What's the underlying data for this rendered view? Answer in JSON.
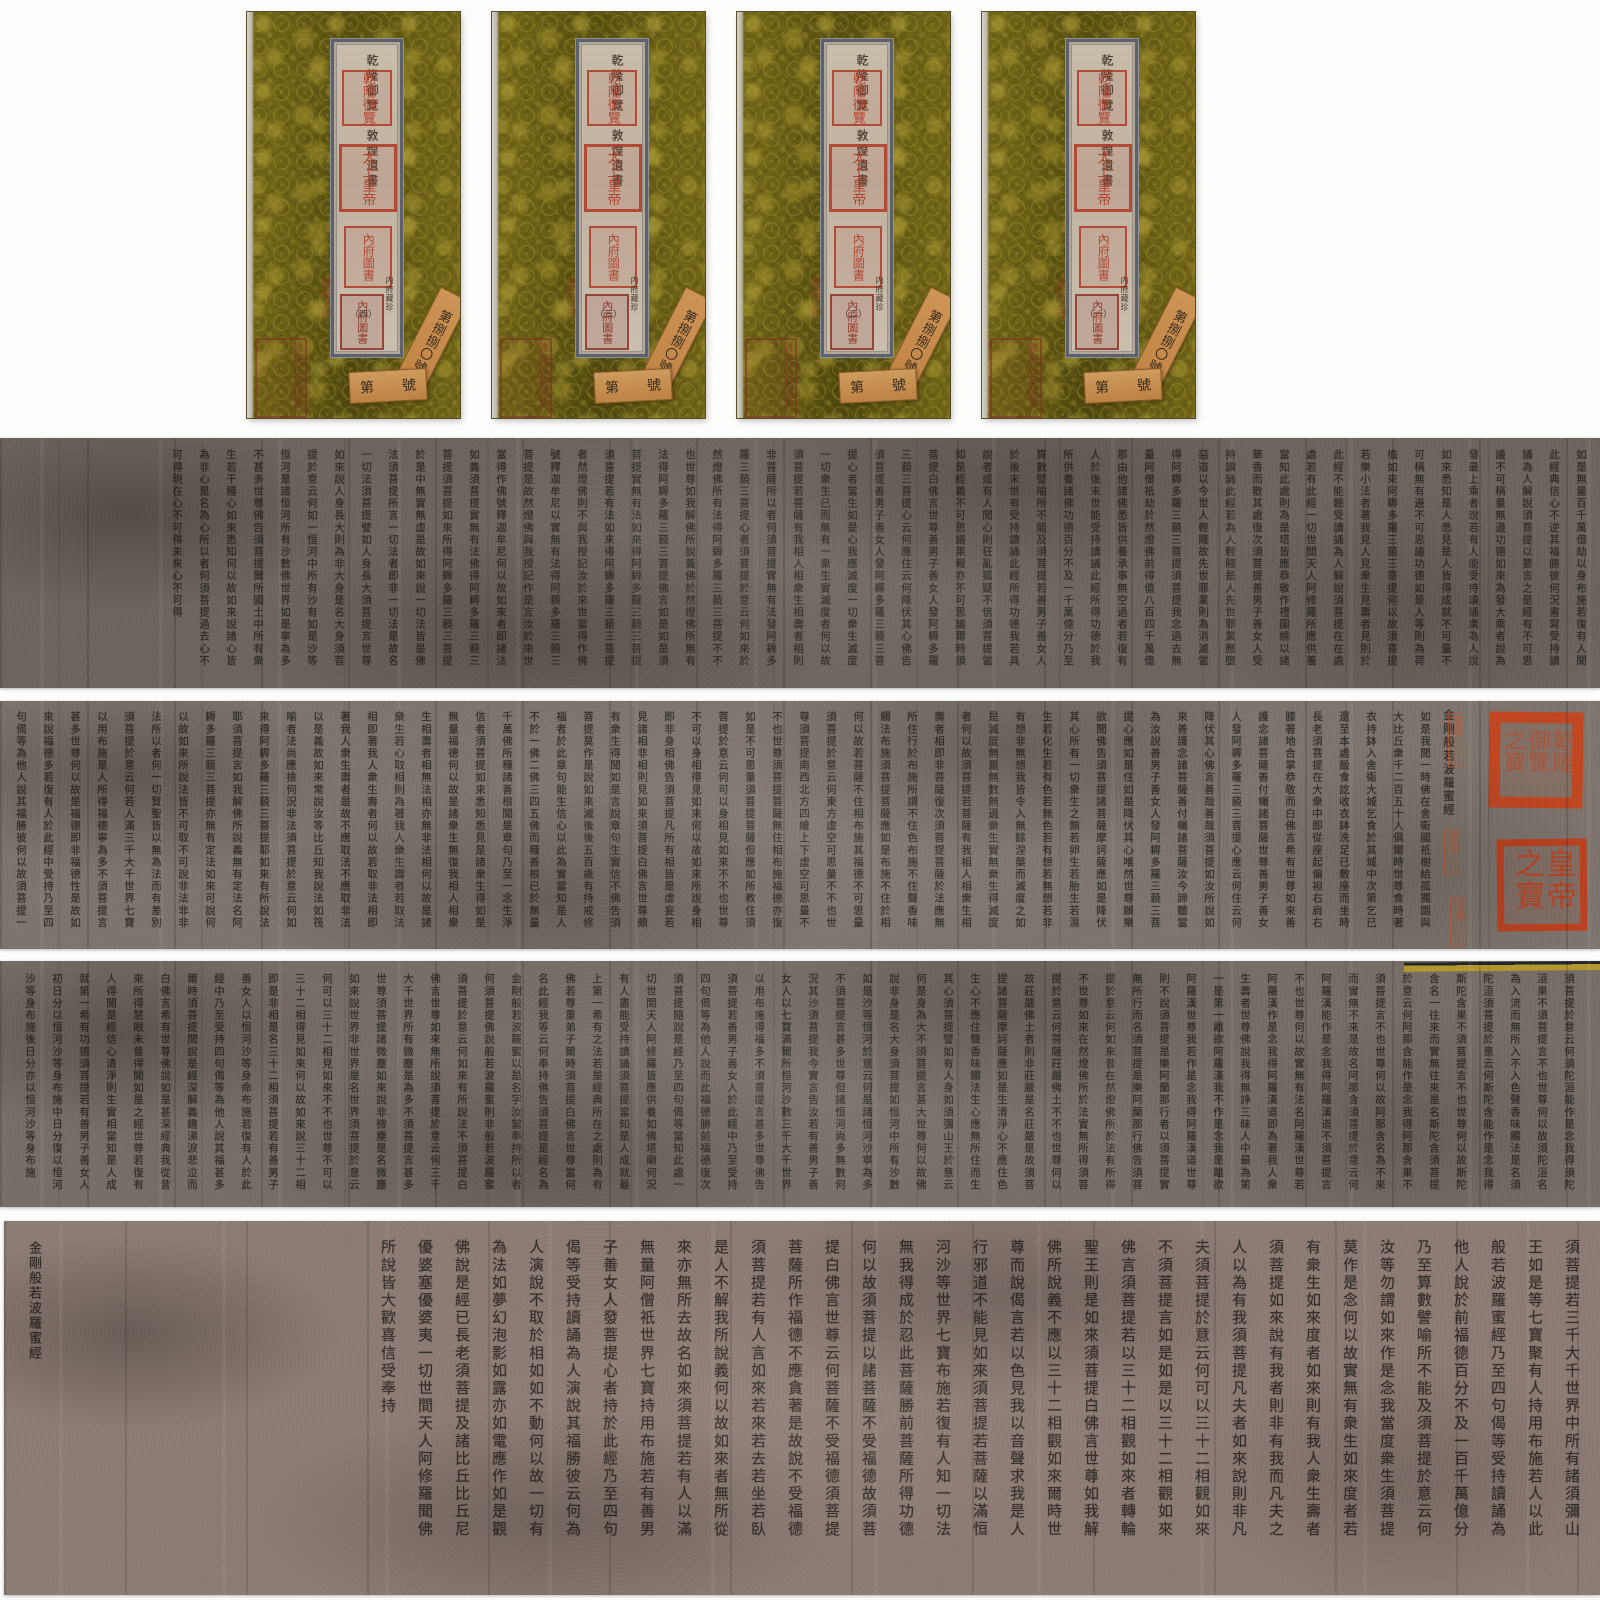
{
  "artifact": {
    "description_title": "金剛般若波羅蜜經",
    "seal_red": "#c6441c",
    "brocade_gold": "#6d6215",
    "tag_orange": "#c8904e",
    "label_beige": "#c3b7a6"
  },
  "covers": [
    {
      "label_line": "乾隆御覽　敦煌遺書",
      "note": "内府藏珍",
      "volume": "（四）",
      "seal_top": "乾隆御覽",
      "seal_mid": "太上皇帝",
      "seal_bottom": "內府圖書",
      "corner_seal": "敦煌石室祕笈",
      "mid_seal": "藏經之印",
      "tag_diagonal": "第捌捌〇號",
      "tag_h_left": "第",
      "tag_h_right": "號"
    },
    {
      "label_line": "乾隆御覽　敦煌遺書",
      "note": "内府藏珍",
      "volume": "（三）",
      "seal_top": "乾隆御覽",
      "seal_mid": "太上皇帝",
      "seal_bottom": "內府圖書",
      "corner_seal": "敦煌石室祕笈",
      "mid_seal": "藏經之印",
      "tag_diagonal": "第捌捌〇號",
      "tag_h_left": "第",
      "tag_h_right": "號"
    },
    {
      "label_line": "乾隆御覽　敦煌遺書",
      "note": "内府藏珍",
      "volume": "（二）",
      "seal_top": "乾隆御覽",
      "seal_mid": "太上皇帝",
      "seal_bottom": "內府圖書",
      "corner_seal": "敦煌石室祕笈",
      "mid_seal": "藏經之印",
      "tag_diagonal": "第捌捌〇號",
      "tag_h_left": "第",
      "tag_h_right": "號"
    },
    {
      "label_line": "乾隆御覽　敦煌遺書",
      "note": "内府藏珍",
      "volume": "（一）",
      "seal_top": "乾隆御覽",
      "seal_mid": "太上皇帝",
      "seal_bottom": "內府圖書",
      "corner_seal": "敦煌石室祕笈",
      "mid_seal": "藏經之印",
      "tag_diagonal": "第捌捌〇號",
      "tag_h_left": "第",
      "tag_h_right": "號"
    }
  ],
  "strips": [
    {
      "text": "如是無量百千萬億劫以身布施若復有人聞此經典信心不逆其福勝彼何況書寫受持讀誦為人解說須菩提以要言之是經有不可思議不可稱量無邊功德如來為發大乘者說為發最上乘者說若有人能受持讀誦廣為人說如來悉知是人悉見是人皆得成就不可量不可稱無有邊不可思議功德如是人等則為荷擔如來阿耨多羅三藐三菩提何以故須菩提若樂小法者著我見人見衆生見壽者見則於此經不能聽受讀誦為人解說須菩提在在處處若有此經一切世間天人阿修羅所應供養當知此處則為是塔皆應恭敬作禮圍繞以諸華香而散其處復次須菩提善男子善女人受持讀誦此經若為人輕賤是人先世罪業應墮惡道以今世人輕賤故先世罪業則為消滅當得阿耨多羅三藐三菩提須菩提我念過去無量阿僧祇劫於然燈佛前得值八百四千萬億那由他諸佛悉皆供養承事無空過者若復有人於後末世能受持讀誦此經所得功德於我所供養諸佛功德百分不及一千萬億分乃至算數譬喻所不能及須菩提若善男子善女人於後末世有受持讀誦此經所得功德我若具說者或有人聞心則狂亂狐疑不信須菩提當知是經義不可思議果報亦不可思議爾時須菩提白佛言世尊善男子善女人發阿耨多羅三藐三菩提心云何應住云何降伏其心佛告須菩提善男子善女人發阿耨多羅三藐三菩提心者當生如是心我應滅度一切衆生滅度一切衆生已而無有一衆生實滅度者何以故須菩提若菩薩有我相人相衆生相壽者相則非菩薩所以者何須菩提實無有法發阿耨多羅三藐三菩提心者須菩提於意云何如來於然燈佛所有法得阿耨多羅三藐三菩提不不也世尊如我解佛所說義佛於然燈佛所無有法得阿耨多羅三藐三菩提佛言如是如是須菩提實無有法如來得阿耨多羅三藐三菩提須菩提若有法如來得阿耨多羅三藐三菩提者然燈佛則不與我授記汝於來世當得作佛號釋迦牟尼以實無有法得阿耨多羅三藐三菩提是故然燈佛與我授記作是言汝於來世當得作佛號釋迦牟尼何以故如來者即諸法如義須菩提實無有法佛得阿耨多羅三藐三菩提須菩提如來所得阿耨多羅三藐三菩提於是中無實無虛是故如來說一切法皆是佛法須菩提所言一切法者即非一切法是故名一切法須菩提譬如人身長大須菩提言世尊如來說人身長大則為非大身是名大身須菩提於意云何如一恒河中所有沙有如是沙等恒河是諸恒河所有沙數佛世界如是寧為多不甚多世尊佛告須菩提爾所國土中所有衆生若干種心如來悉知何以故如來說諸心皆為非心是名為心所以者何須菩提過去心不可得現在心不可得未來心不可得"
    },
    {
      "title": "金剛般若波羅蜜經",
      "seal_upper": "乾隆御覽之寶",
      "seal_lower": "皇帝之寶",
      "mini_seals": [
        "金匱",
        "寶笈",
        "珍藏"
      ],
      "text": "如是我聞一時佛在舍衛國祇樹給孤獨園與大比丘衆千二百五十人俱爾時世尊食時著衣持鉢入舍衛大城乞食於其城中次第乞已還至本處飯食訖收衣鉢洗足已敷座而坐時長老須菩提在大衆中即從座起偏袒右肩右膝著地合掌恭敬而白佛言希有世尊如來善護念諸菩薩善付囑諸菩薩世尊善男子善女人發阿耨多羅三藐三菩提心應云何住云何降伏其心佛言善哉善哉須菩提如汝所說如來善護念諸菩薩善付囑諸菩薩汝今諦聽當為汝說善男子善女人發阿耨多羅三藐三菩提心應如是住如是降伏其心唯然世尊願樂欲聞佛告須菩提諸菩薩摩訶薩應如是降伏其心所有一切衆生之類若卵生若胎生若濕生若化生若有色若無色若有想若無想若非有想非無想我皆令入無餘涅槃而滅度之如是滅度無量無數無邊衆生實無衆生得滅度者何以故須菩提若菩薩有我相人相衆生相壽者相即非菩薩復次須菩提菩薩於法應無所住行於布施所謂不住色布施不住聲香味觸法布施須菩提菩薩應如是布施不住於相何以故若菩薩不住相布施其福德不可思量須菩提於意云何東方虛空可思量不不也世尊須菩提南西北方四維上下虛空可思量不不也世尊須菩提菩薩無住相布施福德亦復如是不可思量須菩提菩薩但應如所教住須菩提於意云何可以身相見如來不不也世尊不可以身相得見如來何以故如來所說身相即非身相佛告須菩提凡所有相皆是虛妄若見諸相非相則見如來須菩提白佛言世尊頗有衆生得聞如是言說章句生實信不佛告須菩提莫作是說如來滅後後五百歲有持戒修福者於此章句能生信心以此為實當知是人不於一佛二佛三四五佛而種善根已於無量千萬佛所種諸善根聞是章句乃至一念生淨信者須菩提如來悉知悉見是諸衆生得如是無量福德何以故是諸衆生無復我相人相衆生相壽者相無法相亦無非法相何以故是諸衆生若心取相則為著我人衆生壽者若取法相即著我人衆生壽者何以故若取非法相即著我人衆生壽者是故不應取法不應取非法以是義故如來常說汝等比丘知我說法如筏喻者法尚應捨何況非法須菩提於意云何如來得阿耨多羅三藐三菩提耶如來有所說法耶須菩提言如我解佛所說義無有定法名阿耨多羅三藐三菩提亦無有定法如來可說何以故如來所說法皆不可取不可說非法非非法所以者何一切賢聖皆以無為法而有差別須菩提於意云何若人滿三千大千世界七寶以用布施是人所得福德寧為多不須菩提言甚多世尊何以故是福德即非福德性是故如來說福德多若復有人於此經中受持乃至四句偈等為他人說其福勝彼何以故須菩提一切諸佛及諸佛阿耨多羅三藐三菩提法皆從此經出須菩提所謂佛法者即非佛法"
    },
    {
      "text": "須菩提於意云何須陀洹能作是念我得須陀洹果不須菩提言不也世尊何以故須陀洹名為入流而無所入不入色聲香味觸法是名須陀洹須菩提於意云何斯陀含能作是念我得斯陀含果不須菩提言不也世尊何以故斯陀含名一往來而實無往來是名斯陀含須菩提於意云何阿那含能作是念我得阿那含果不須菩提言不也世尊何以故阿那含名為不來而實無不來是故名阿那含須菩提於意云何阿羅漢能作是念我得阿羅漢道不須菩提言不也世尊何以故實無有法名阿羅漢世尊若阿羅漢作是念我得阿羅漢道即為著我人衆生壽者世尊佛說我得無諍三昧人中最為第一是第一離欲阿羅漢我不作是念我是離欲阿羅漢世尊我若作是念我得阿羅漢道世尊則不說須菩提是樂阿蘭那行者以須菩提實無所行而名須菩提是樂阿蘭那行佛告須菩提於意云何如來昔在然燈佛所於法有所得不世尊如來在然燈佛所於法實無所得須菩提於意云何菩薩莊嚴佛土不不也世尊何以故莊嚴佛土者則非莊嚴是名莊嚴是故須菩提諸菩薩摩訶薩應如是生清淨心不應住色生心不應住聲香味觸法生心應無所住而生其心須菩提譬如有人身如須彌山王於意云何是身為大不須菩提言甚大世尊何以故佛說非身是名大身須菩提如恒河中所有沙數如是沙等恒河於意云何是諸恒河沙寧為多不須菩提言甚多世尊但諸恒河尚多無數何況其沙須菩提我今實言告汝若有善男子善女人以七寶滿爾所恒河沙數三千大千世界以用布施得福多不須菩提言甚多世尊佛告須菩提若善男子善女人於此經中乃至受持四句偈等為他人說而此福德勝前福德復次須菩提隨說是經乃至四句偈等當知此處一切世間天人阿修羅皆應供養如佛塔廟何況有人盡能受持讀誦須菩提當知是人成就最上第一希有之法若是經典所在之處則為有佛若尊重弟子爾時須菩提白佛言世尊當何名此經我等云何奉持佛告須菩提是經名為金剛般若波羅蜜以是名字汝當奉持所以者何須菩提佛說般若波羅蜜則非般若波羅蜜須菩提於意云何如來有所說法不須菩提白佛言世尊如來無所說須菩提於意云何三千大千世界所有微塵是為多不須菩提言甚多世尊須菩提諸微塵如來說非微塵是名微塵如來說世界非世界是名世界須菩提於意云何可以三十二相見如來不不也世尊不可以三十二相得見如來何以故如來說三十二相即是非相是名三十二相須菩提若有善男子善女人以恒河沙等身命布施若復有人於此經中乃至受持四句偈等為他人說其福甚多爾時須菩提聞說是經深解義趣涕淚悲泣而白佛言希有世尊佛說如是甚深經典我從昔來所得慧眼未曾得聞如是之經世尊若復有人得聞是經信心清淨則生實相當知是人成就第一希有功德須菩提若有善男子善女人初日分以恒河沙等身布施中日分復以恒河沙等身布施後日分亦以恒河沙等身布施"
    },
    {
      "end_title": "金剛般若波羅蜜經",
      "text": "須菩提若三千大千世界中所有諸須彌山王如是等七寶聚有人持用布施若人以此般若波羅蜜經乃至四句偈等受持讀誦為他人說於前福德百分不及一百千萬億分乃至算數譬喻所不能及須菩提於意云何汝等勿謂如來作是念我當度衆生須菩提莫作是念何以故實無有衆生如來度者若有衆生如來度者如來則有我人衆生壽者須菩提如來說有我者則非有我而凡夫之人以為有我須菩提凡夫者如來說則非凡夫須菩提於意云何可以三十二相觀如來不須菩提言如是如是以三十二相觀如來佛言須菩提若以三十二相觀如來者轉輪聖王則是如來須菩提白佛言世尊如我解佛所說義不應以三十二相觀如來爾時世尊而說偈言若以色見我以音聲求我是人行邪道不能見如來須菩提若菩薩以滿恒河沙等世界七寶布施若復有人知一切法無我得成於忍此菩薩勝前菩薩所得功德何以故須菩提以諸菩薩不受福德故須菩提白佛言世尊云何菩薩不受福德須菩提菩薩所作福德不應貪著是故說不受福德須菩提若有人言如來若來若去若坐若臥是人不解我所說義何以故如來者無所從來亦無所去故名如來須菩提若有人以滿無量阿僧祇世界七寶持用布施若有善男子善女人發菩提心者持於此經乃至四句偈等受持讀誦為人演說其福勝彼云何為人演說不取於相如如不動何以故一切有為法如夢幻泡影如露亦如電應作如是觀佛說是經已長老須菩提及諸比丘比丘尼優婆塞優婆夷一切世間天人阿修羅聞佛所說皆大歡喜信受奉持"
    }
  ]
}
